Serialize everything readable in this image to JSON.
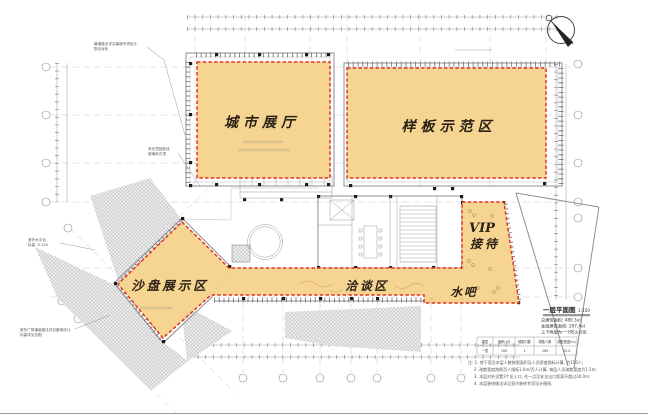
{
  "plan": {
    "zones": {
      "city_hall": "城市展厅",
      "sample_area": "样板示范区",
      "sand_table": "沙盘展示区",
      "negotiation": "洽谈区",
      "water_bar": "水吧",
      "vip_line1": "VIP",
      "vip_line2": "接待"
    },
    "title_block": {
      "title": "一层平面图",
      "scale": "1:150",
      "info_lines": [
        "总建筑面积: 489.3㎡",
        "本层建筑面积: 297.4㎡",
        "上下两层为一个防火分区"
      ],
      "table": {
        "headers": [
          "楼层",
          "面积(㎡)",
          "疏散口数",
          "疏散人数",
          "疏散宽度(m)"
        ],
        "row": [
          "一层",
          "150",
          "1",
          "164",
          "15.4"
        ]
      },
      "notes": [
        "注: 1. 地下室及本层人数按照面积及人员密度指标计算, 约150人;",
        "2. 疏散宽度按照百人指标1.0m/百人计算, 每层人员疏散宽度为1.5m;",
        "3. 本层对外设置3个出入口, 任一点至安全出口距离不超过30.0m;",
        "4. 本层装修做法详见室内装修专项设计图纸."
      ]
    },
    "annotations": {
      "a1": "幕墙做法详见幕墙专项设计",
      "a1b": "配合深化",
      "a2": "采光顶投影线",
      "a2b": "玻璃采光顶",
      "a3": "室外木平台",
      "a3b": "标高 -0.150",
      "a4": "室外广场铺装做法详见景观设计,",
      "a4b": "标高详见总图"
    },
    "colors": {
      "zone_fill": "#F5D38D",
      "zone_border": "#E0351F"
    }
  }
}
